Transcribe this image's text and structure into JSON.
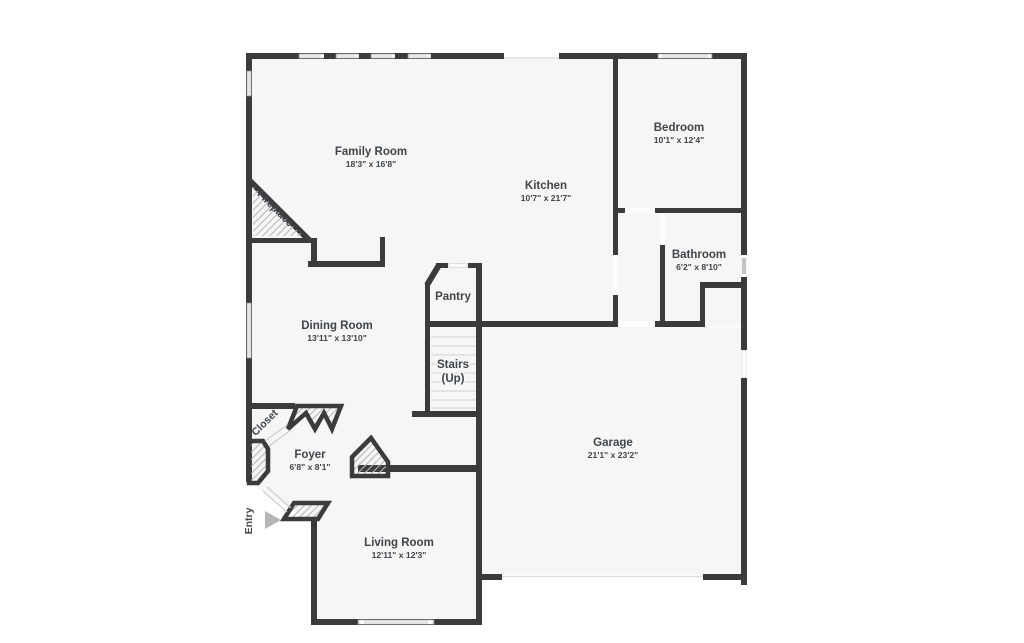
{
  "colors": {
    "wall": "#3b3b3d",
    "floor": "#f6f6f6",
    "text": "#3f454b",
    "hatch": "#b8b8b8",
    "arrow": "#b6b6b6"
  },
  "rooms": {
    "family_room": {
      "name": "Family Room",
      "dims": "18'3\" x 16'8\""
    },
    "kitchen": {
      "name": "Kitchen",
      "dims": "10'7\" x 21'7\""
    },
    "bedroom": {
      "name": "Bedroom",
      "dims": "10'1\" x 12'4\""
    },
    "bathroom": {
      "name": "Bathroom",
      "dims": "6'2\" x 8'10\""
    },
    "pantry": {
      "name": "Pantry",
      "dims": ""
    },
    "dining_room": {
      "name": "Dining Room",
      "dims": "13'11\" x 13'10\""
    },
    "stairs": {
      "name": "Stairs",
      "dims": "(Up)"
    },
    "garage": {
      "name": "Garage",
      "dims": "21'1\" x 23'2\""
    },
    "foyer": {
      "name": "Foyer",
      "dims": "6'8\" x 8'1\""
    },
    "living_room": {
      "name": "Living Room",
      "dims": "12'11\" x 12'3\""
    }
  },
  "annotations": {
    "fireplace": "Fireplace",
    "closet": "Closet",
    "entry": "Entry"
  }
}
